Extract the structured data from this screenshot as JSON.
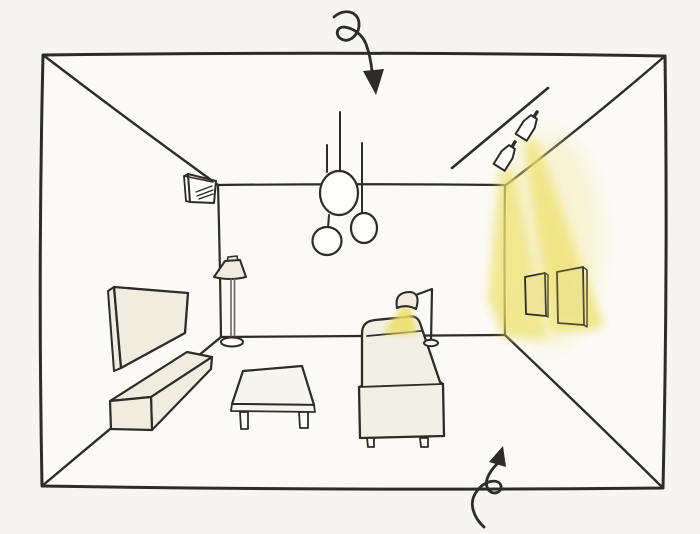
{
  "scene": {
    "description": "Hand-drawn one-point-perspective sketch of a living room interior showing a lighting plan: ceiling pendant cluster, track spotlights washing two wall pictures with yellow light, a reading lamp casting yellow light onto a sofa, plus TV, console, coffee table, floor lamp and air conditioner. Two looping ink arrows point into the room from top and bottom.",
    "objects": [
      "room-box",
      "ceiling-pendant-lights",
      "track-spotlights",
      "spotlight-beams",
      "picture-frames",
      "air-conditioner",
      "wall-tv",
      "tv-console",
      "coffee-table",
      "floor-lamp",
      "sofa",
      "reading-lamp",
      "reading-lamp-beam",
      "arrow-top",
      "arrow-bottom"
    ]
  },
  "colors": {
    "paper": "#f6f5f2",
    "room_fill": "#fbfaf7",
    "ink": "#2e2b28",
    "furniture_cream": "#f0ecdf",
    "sofa_cream": "#f2efe4",
    "table_white": "#f7f5ef",
    "light_yellow": "#ecdf63",
    "light_yellow_soft": "#f3e892",
    "frame_lit": "#efe59a",
    "white": "#fdfdfb",
    "pole_gray": "#6b6861"
  }
}
